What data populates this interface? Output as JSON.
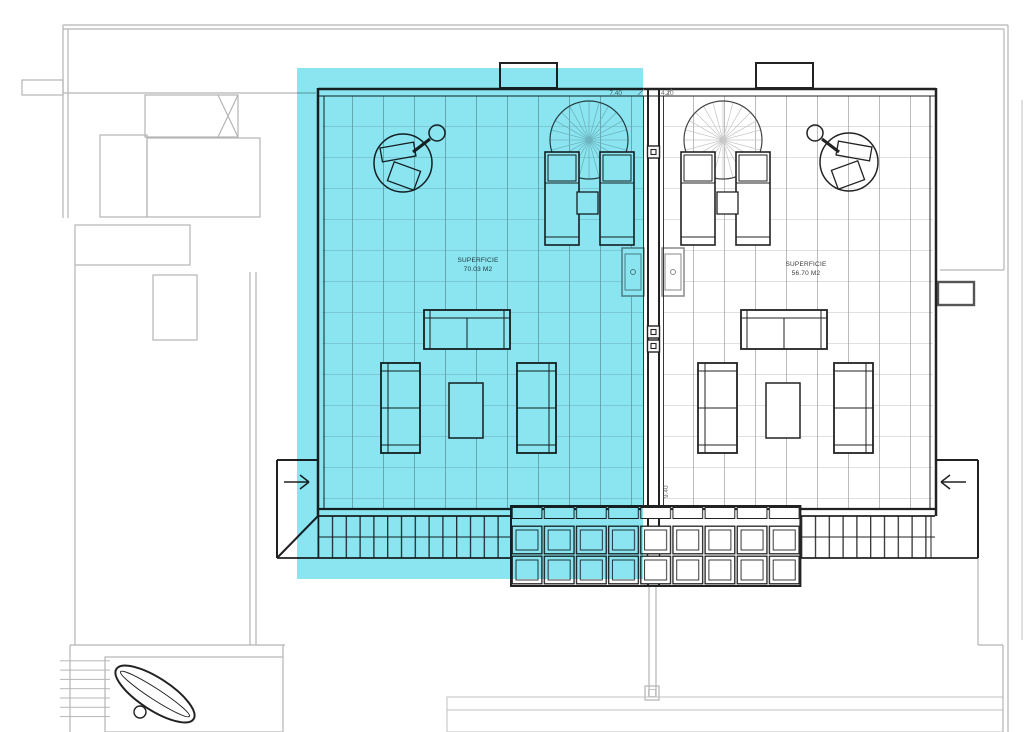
{
  "labels": {
    "left_unit": {
      "line1": "SUPERFICIE",
      "line2": "70.03 M2"
    },
    "right_unit": {
      "line1": "SUPERFICIE",
      "line2": "56.70 M2"
    }
  },
  "dimensions": {
    "left_width": "7.40",
    "right_width": "4.10",
    "depth": "9.40"
  },
  "colors": {
    "highlight_cyan": "#8AE5F1",
    "plan_line_dark": "#222222",
    "background_line_gray": "#b5b5b5",
    "grid_line_gray": "#ababab",
    "page_background": "#ffffff"
  }
}
